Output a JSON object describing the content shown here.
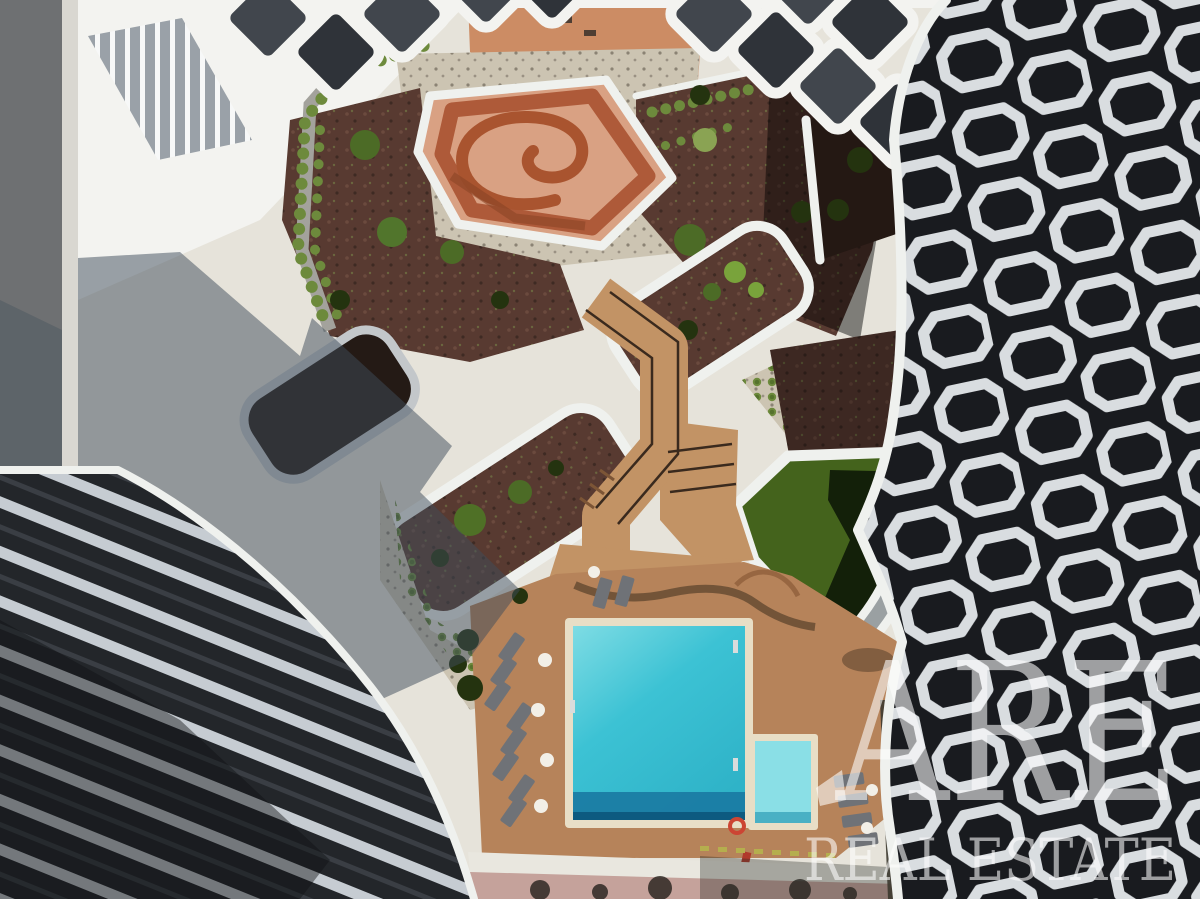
{
  "image": {
    "description": "Aerial top-down drone photograph of a residential condominium courtyard with a turquoise swimming pool, timber deck with sun loungers, a terracotta spiral play bowl, curved white-edged garden beds, green lawn, and two sculptural buildings (one with white chevron-striped balconies, one with white octagonal balcony frames)."
  },
  "watermark": {
    "line1": "ARE",
    "line2": "REAL ESTATE"
  },
  "palette": {
    "street": "#6e7072",
    "sidewalk": "#d9d7d1",
    "plaza": "#e6e3da",
    "white_roof": "#f3f3f0",
    "slat_bg": "#9aa1a8",
    "slat": "#f7f8f8",
    "terracotta": "#cc8c64",
    "gravel": "#ccc4b2",
    "gravel_speck": "#8b8374",
    "mulch": "#583a31",
    "mulch_dark": "#241813",
    "shrub": "#6d8a3c",
    "bush": "#4c6b26",
    "bush_dark": "#24330f",
    "lawn": "#44631c",
    "lawn_shadow": "#0a1406",
    "deck": "#b6835a",
    "wood_ramp": "#c29365",
    "pool_border": "#e8dec6",
    "pool_light": "#7edce4",
    "pool_mid": "#3cc2d4",
    "pool_deep": "#2fb3c8",
    "pool_shadow": "#1a7ba3",
    "kids_water": "#8adfe6",
    "lounger": "#6f7277",
    "umbrella": "#f2efe7",
    "railing": "#3a2a1e",
    "walkway_gray": "#9aa0a2",
    "path_light": "#e9e7df",
    "pavers_pink": "#c5a29b",
    "paver_blob": "#26211c",
    "facade_dark": "#23262a",
    "facade_dark2": "#191b1f",
    "stripe_light": "#c6ccd2",
    "balcony_white": "#d9dde0",
    "parapet_white": "#eff1ee",
    "shadow_blue": "#3e4c59",
    "bowl_wall": "#ae5a39",
    "bowl_floor": "#d9a183",
    "spiral_wall": "#a9542f",
    "watermark_color": "#ffffff"
  }
}
